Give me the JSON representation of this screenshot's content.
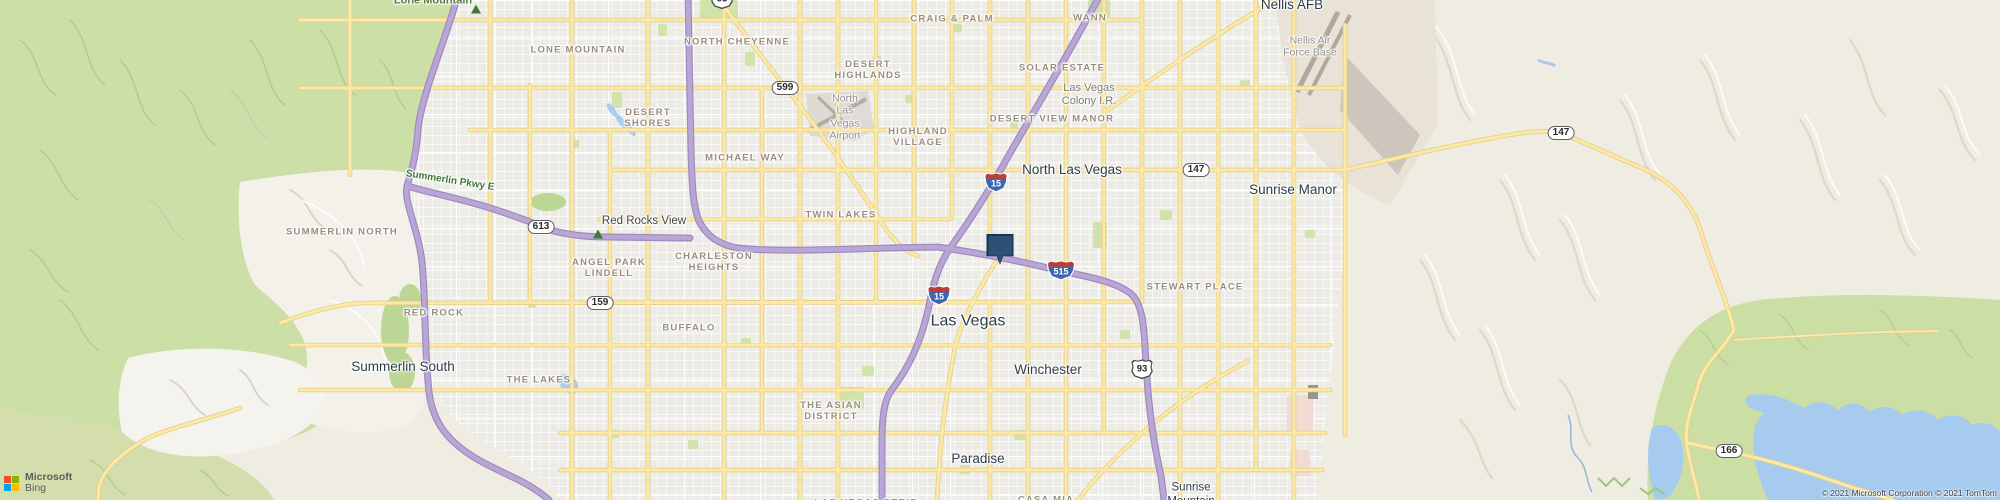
{
  "map": {
    "labels": [
      {
        "text": "Lone Mountain",
        "x": 433,
        "y": 1,
        "cls": "mtn"
      },
      {
        "text": "LONE MOUNTAIN",
        "x": 578,
        "y": 50,
        "cls": "hood"
      },
      {
        "text": "NORTH CHEYENNE",
        "x": 737,
        "y": 42,
        "cls": "hood"
      },
      {
        "text": "CRAIG & PALM",
        "x": 952,
        "y": 19,
        "cls": "hood"
      },
      {
        "text": "WANN",
        "x": 1090,
        "y": 18,
        "cls": "hood"
      },
      {
        "text": "Nellis AFB",
        "x": 1292,
        "y": 5,
        "cls": "city"
      },
      {
        "text": "DESERT\nHIGHLANDS",
        "x": 868,
        "y": 70,
        "cls": "hood"
      },
      {
        "text": "SOLAR ESTATE",
        "x": 1062,
        "y": 68,
        "cls": "hood"
      },
      {
        "text": "Las Vegas\nColony I.R.",
        "x": 1089,
        "y": 95,
        "cls": "grayd"
      },
      {
        "text": "DESERT VIEW MANOR",
        "x": 1052,
        "y": 119,
        "cls": "hood"
      },
      {
        "text": "Nellis Air\nForce Base",
        "x": 1310,
        "y": 47,
        "cls": "gray"
      },
      {
        "text": "DESERT\nSHORES",
        "x": 648,
        "y": 118,
        "cls": "hood"
      },
      {
        "text": "North\nLas\nVegas\nAirport",
        "x": 845,
        "y": 117,
        "cls": "gray"
      },
      {
        "text": "HIGHLAND\nVILLAGE",
        "x": 918,
        "y": 137,
        "cls": "hood"
      },
      {
        "text": "MICHAEL WAY",
        "x": 745,
        "y": 158,
        "cls": "hood"
      },
      {
        "text": "North Las Vegas",
        "x": 1072,
        "y": 170,
        "cls": "city"
      },
      {
        "text": "Sunrise Manor",
        "x": 1293,
        "y": 190,
        "cls": "city"
      },
      {
        "text": "Summerlin Pkwy E",
        "x": 450,
        "y": 181,
        "cls": "roadgreen",
        "rot": 9
      },
      {
        "text": "Red Rocks View",
        "x": 644,
        "y": 222,
        "cls": "poi"
      },
      {
        "text": "TWIN LAKES",
        "x": 841,
        "y": 215,
        "cls": "hood"
      },
      {
        "text": "SUMMERLIN NORTH",
        "x": 342,
        "y": 232,
        "cls": "hood"
      },
      {
        "text": "ANGEL PARK\nLINDELL",
        "x": 609,
        "y": 268,
        "cls": "hood"
      },
      {
        "text": "CHARLESTON\nHEIGHTS",
        "x": 714,
        "y": 262,
        "cls": "hood"
      },
      {
        "text": "STEWART PLACE",
        "x": 1195,
        "y": 287,
        "cls": "hood"
      },
      {
        "text": "RED ROCK",
        "x": 434,
        "y": 313,
        "cls": "hood"
      },
      {
        "text": "Las Vegas",
        "x": 968,
        "y": 322,
        "cls": "citymajor"
      },
      {
        "text": "BUFFALO",
        "x": 689,
        "y": 328,
        "cls": "hood"
      },
      {
        "text": "Summerlin South",
        "x": 403,
        "y": 367,
        "cls": "city"
      },
      {
        "text": "Winchester",
        "x": 1048,
        "y": 370,
        "cls": "city"
      },
      {
        "text": "THE LAKES",
        "x": 539,
        "y": 380,
        "cls": "hood"
      },
      {
        "text": "THE ASIAN\nDISTRICT",
        "x": 831,
        "y": 411,
        "cls": "hood"
      },
      {
        "text": "Paradise",
        "x": 978,
        "y": 459,
        "cls": "city"
      },
      {
        "text": "Sunrise\nMountain",
        "x": 1191,
        "y": 495,
        "cls": "citysm"
      },
      {
        "text": "CASA MIA",
        "x": 1046,
        "y": 500,
        "cls": "hood"
      },
      {
        "text": "LAS VEGAS STRIP",
        "x": 866,
        "y": 503,
        "cls": "hood"
      }
    ],
    "peak_markers": [
      {
        "name": "lone-mountain-peak",
        "x": 476,
        "y": 9
      },
      {
        "name": "red-rocks-view-peak",
        "x": 598,
        "y": 234
      }
    ],
    "shields": [
      {
        "num": "95",
        "x": 722,
        "y": -1,
        "kind": "us"
      },
      {
        "num": "599",
        "x": 785,
        "y": 88,
        "kind": "state"
      },
      {
        "num": "613",
        "x": 541,
        "y": 227,
        "kind": "state"
      },
      {
        "num": "159",
        "x": 600,
        "y": 303,
        "kind": "state"
      },
      {
        "num": "147",
        "x": 1196,
        "y": 170,
        "kind": "state"
      },
      {
        "num": "147",
        "x": 1561,
        "y": 133,
        "kind": "state"
      },
      {
        "num": "166",
        "x": 1729,
        "y": 451,
        "kind": "state"
      },
      {
        "num": "93",
        "x": 1142,
        "y": 369,
        "kind": "us"
      },
      {
        "num": "15",
        "x": 996,
        "y": 182,
        "kind": "interstate"
      },
      {
        "num": "15",
        "x": 939,
        "y": 295,
        "kind": "interstate"
      },
      {
        "num": "515",
        "x": 1061,
        "y": 270,
        "kind": "interstate"
      }
    ],
    "marker": {
      "x": 1000,
      "y": 250,
      "fill": "#2c5078",
      "border": "#173450"
    }
  },
  "attribution": {
    "brand_line1": "Microsoft",
    "brand_line2": "Bing",
    "logo_colors": {
      "tl": "#f25022",
      "tr": "#7fba00",
      "bl": "#00a4ef",
      "br": "#ffb900"
    },
    "copyright": "© 2021 Microsoft Corporation © 2021 TomTom"
  },
  "colors": {
    "freeway": "#b9a6d5",
    "freeway_casing": "#9e89c0",
    "road_yellow": "#fbe9a7",
    "road_yellow_casing": "#e6cc85",
    "water": "#a6cbee",
    "vegetation": "#ccdfa6",
    "desert": "#efece2",
    "urban_block": "#ecebe6"
  }
}
